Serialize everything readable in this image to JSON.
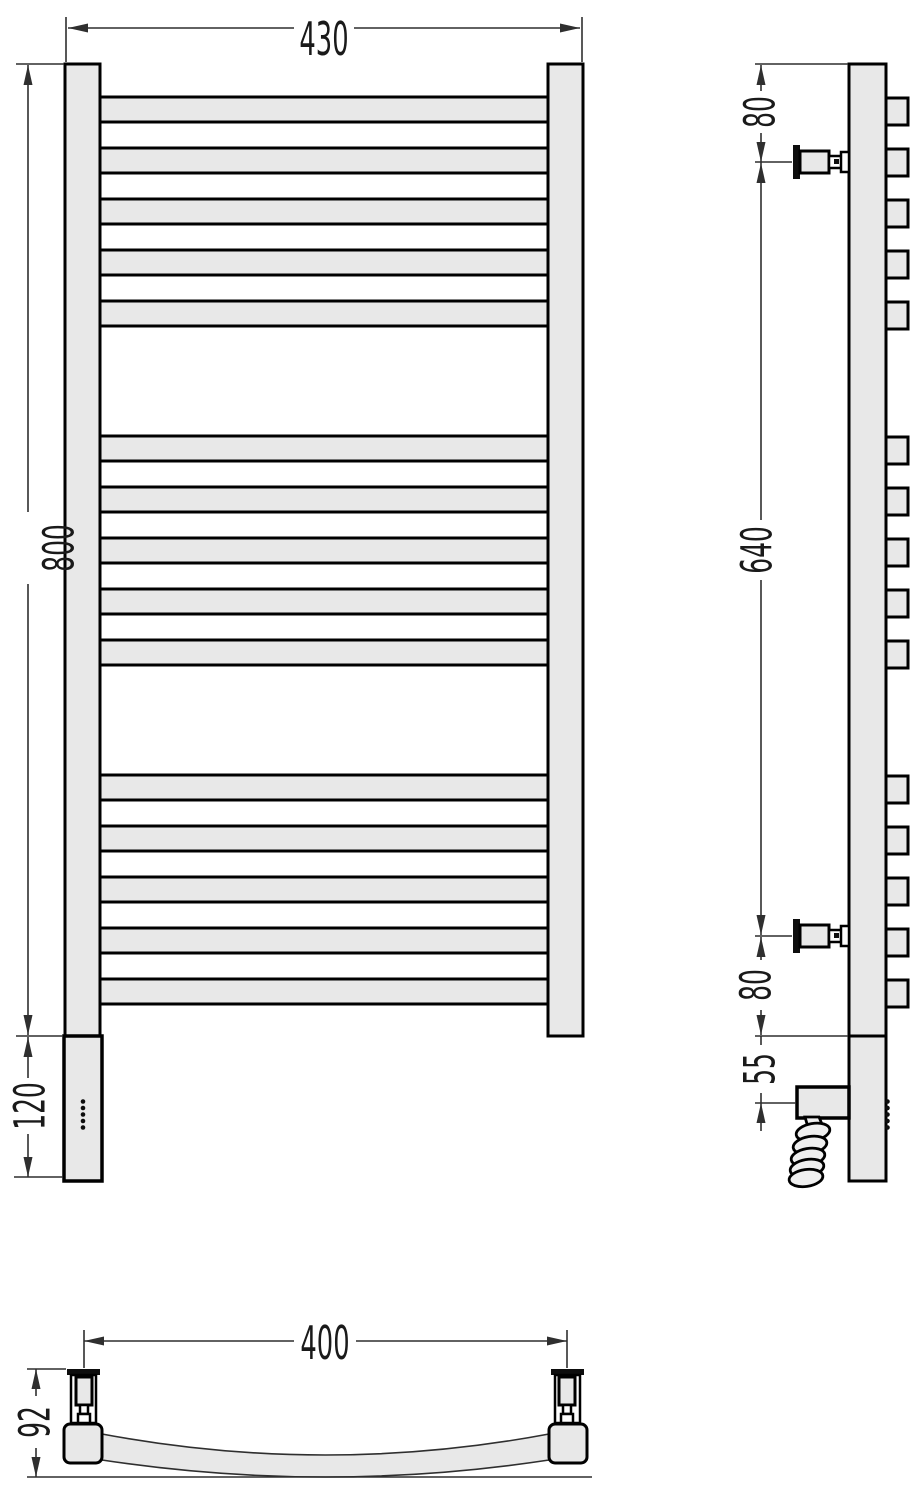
{
  "figure": {
    "kind": "technical-drawing",
    "subject": "curved heated towel rail, three orthographic views",
    "rungs": {
      "count": 15,
      "groups": 3,
      "per_group": 5
    },
    "indicator_dots": 5
  },
  "dims": {
    "front_width": "430",
    "front_height": "800",
    "front_bottom": "120",
    "side_top": "80",
    "side_span": "640",
    "side_bottom": "80",
    "side_heater": "55",
    "bottom_span": "400",
    "bottom_depth": "92"
  },
  "colors": {
    "part_fill": "#e8e8e8",
    "outline": "#000000",
    "dimension_lines": "#2f2f2f",
    "text": "#1a1a1a",
    "background": "#ffffff"
  }
}
